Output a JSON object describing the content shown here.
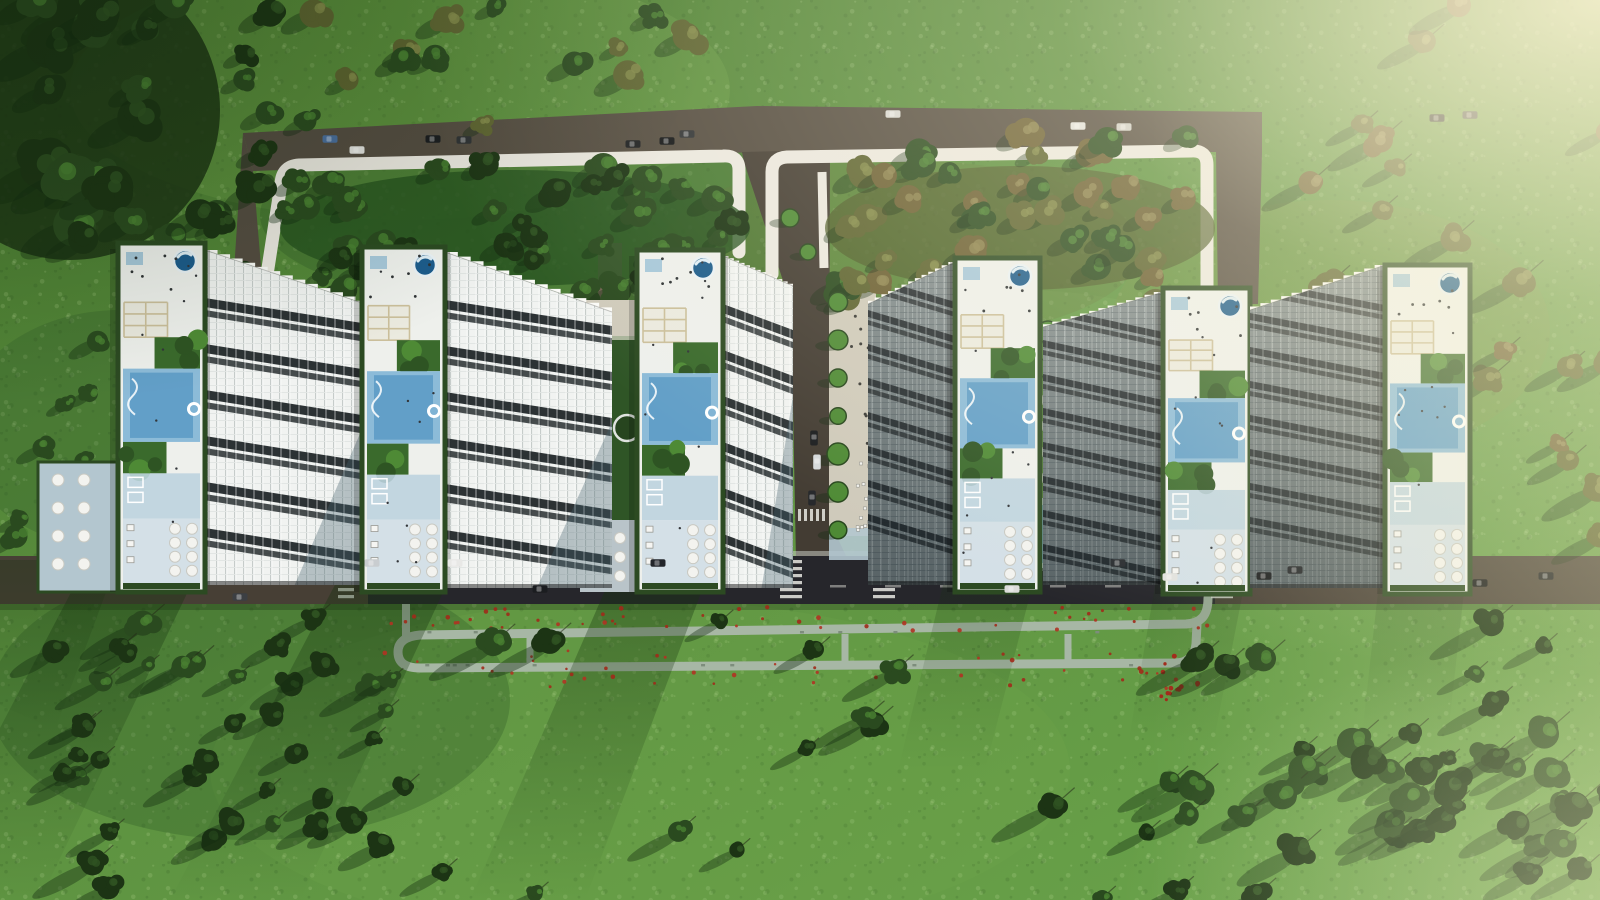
{
  "scene": {
    "title": "Aerial site-plan rendering of a residential complex",
    "view": "top-down bird's-eye view",
    "setting": "Six high-rise slab towers with landscaped roof gardens set in a forested green park",
    "towers": 6,
    "features": [
      "upper ring access road with white sidewalk loops",
      "tree-filled courtyards inside the road loops",
      "central access road between the two tower groups",
      "lower street with marked parking stalls and crosswalks",
      "pedestrian jogging loop with red flower beds",
      "rooftop circular pools, lap pools, pergolas, gardens and umbrella decks",
      "scattered cars on the roads",
      "sunlight glare from the upper right"
    ],
    "lighting": "daylight, sun from upper right, long tree shadows to lower left"
  },
  "colors": {
    "grass_base": "#5d9240",
    "grass_mid": "#4f8136",
    "grass_light": "#84b556",
    "grass_dark": "#39662c",
    "shadow_green": "#16330f",
    "forest_dark": "#2a4a1f",
    "forest_deep": "#1c3414",
    "tree_olive": "#5d6330",
    "tree_brown": "#6b5f33",
    "canopy_highlight": "#498031",
    "road_asphalt": "#544c41",
    "road_dark": "#26262b",
    "road_brown": "#473f35",
    "sidewalk": "#ebe8e0",
    "path": "#a7b7a5",
    "plaza_beige": "#cfcabb",
    "walk_blue": "#b3c6cf",
    "facade_light": "#f1f3f1",
    "facade_line": "#c6ccca",
    "facade_shaded": "#8a9496",
    "facade_shaded_line": "#aab4b5",
    "window_band": "#1b2224",
    "window_band_dark": "#23282c",
    "roof_deck": "#eef0ec",
    "roof_blue": "#bdd3df",
    "pool_light": "#8cbbd8",
    "pool_core": "#5d9cc6",
    "pool_deep": "#1c5c8c",
    "garden": "#3a6a2c",
    "hedge": "#2c4a22",
    "pergola": "#cbbf9b",
    "umbrella": "#f3f3ef",
    "flower_red": "#a12a1a",
    "car_white": "#e2e2df",
    "car_dark": "#1b1d20",
    "glare": "#fff6d8"
  }
}
